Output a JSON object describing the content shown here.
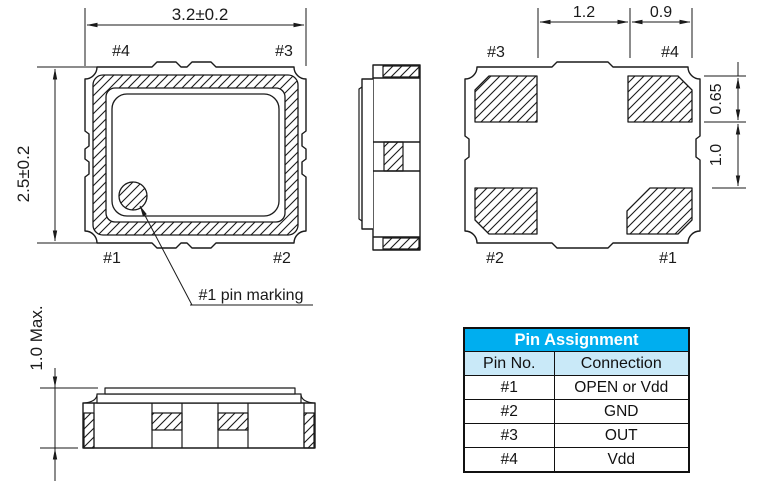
{
  "page": {
    "background": "#ffffff"
  },
  "colors": {
    "table_header_bg": "#00AEEF",
    "table_subheader_bg": "#C9E9F8",
    "table_header_text": "#FFFFFF",
    "line_color": "#1A1A1A"
  },
  "top_view": {
    "dim_width": "3.2±0.2",
    "dim_height": "2.5±0.2",
    "pin_top_left": "#4",
    "pin_top_right": "#3",
    "pin_bottom_left": "#1",
    "pin_bottom_right": "#2",
    "marking_label": "#1 pin marking"
  },
  "bottom_view": {
    "dim_center_span": "1.2",
    "dim_pad_width": "0.9",
    "dim_pad_height": "0.65",
    "dim_pad_gap": "1.0",
    "pin_top_left": "#3",
    "pin_top_right": "#4",
    "pin_bottom_left": "#2",
    "pin_bottom_right": "#1"
  },
  "front_view": {
    "dim_height": "1.0 Max."
  },
  "pin_table": {
    "title": "Pin Assignment",
    "columns": [
      "Pin No.",
      "Connection"
    ],
    "rows": [
      {
        "pin": "#1",
        "connection": "OPEN or Vdd"
      },
      {
        "pin": "#2",
        "connection": "GND"
      },
      {
        "pin": "#3",
        "connection": "OUT"
      },
      {
        "pin": "#4",
        "connection": "Vdd"
      }
    ]
  }
}
